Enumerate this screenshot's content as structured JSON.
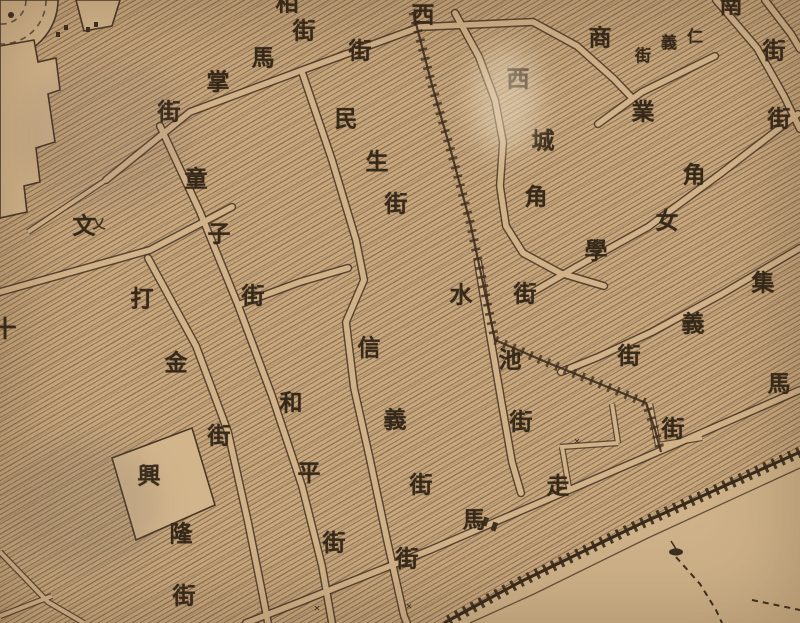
{
  "map": {
    "kind": "antique-chinese-city-street-map",
    "language": "Chinese (traditional), labels read vertically / along streets",
    "colors": {
      "paper": "#c8a77d",
      "road_fill": "#d2b289",
      "ink": "#3f2f1f",
      "label_ink": "#37291a",
      "hatch_line": "rgba(72,54,36,0.42)"
    },
    "default_char_size": 23,
    "streets": [
      {
        "id": "mazhang-jie",
        "name": "馬掌街",
        "chars": [
          {
            "ch": "馬",
            "x": 263,
            "y": 58
          },
          {
            "ch": "掌",
            "x": 218,
            "y": 82
          },
          {
            "ch": "街",
            "x": 169,
            "y": 112
          }
        ]
      },
      {
        "id": "top-edge-street",
        "name": "相街(上緣截斷)",
        "chars": [
          {
            "ch": "相",
            "x": 287,
            "y": 3
          },
          {
            "ch": "街",
            "x": 304,
            "y": 31
          }
        ]
      },
      {
        "id": "xi-jie",
        "name": "西街",
        "chars": [
          {
            "ch": "西",
            "x": 423,
            "y": 15
          },
          {
            "ch": "街",
            "x": 360,
            "y": 51
          }
        ]
      },
      {
        "id": "minsheng-jie",
        "name": "民生街",
        "chars": [
          {
            "ch": "民",
            "x": 346,
            "y": 119
          },
          {
            "ch": "生",
            "x": 377,
            "y": 162
          },
          {
            "ch": "街",
            "x": 396,
            "y": 204
          }
        ]
      },
      {
        "id": "xicheng-jiao",
        "name": "西城角",
        "chars": [
          {
            "ch": "西",
            "x": 518,
            "y": 79
          },
          {
            "ch": "城",
            "x": 543,
            "y": 141
          },
          {
            "ch": "角",
            "x": 536,
            "y": 197
          }
        ]
      },
      {
        "id": "shangye-jiao",
        "name": "商業角",
        "chars": [
          {
            "ch": "商",
            "x": 600,
            "y": 38
          },
          {
            "ch": "業",
            "x": 643,
            "y": 112
          },
          {
            "ch": "角",
            "x": 694,
            "y": 175
          }
        ]
      },
      {
        "id": "renyi-jie",
        "name": "仁義街",
        "chars": [
          {
            "ch": "仁",
            "x": 695,
            "y": 38,
            "size": 16
          },
          {
            "ch": "義",
            "x": 669,
            "y": 44,
            "size": 16
          },
          {
            "ch": "街",
            "x": 643,
            "y": 57,
            "size": 16
          }
        ]
      },
      {
        "id": "nan-jie",
        "name": "南…街(右上)",
        "chars": [
          {
            "ch": "南",
            "x": 731,
            "y": 5
          },
          {
            "ch": "街",
            "x": 774,
            "y": 51
          }
        ]
      },
      {
        "id": "right-edge-jie",
        "name": "…街(右緣)",
        "chars": [
          {
            "ch": "街",
            "x": 779,
            "y": 119
          }
        ]
      },
      {
        "id": "nvxue-jie",
        "name": "女學街",
        "chars": [
          {
            "ch": "女",
            "x": 667,
            "y": 221
          },
          {
            "ch": "學",
            "x": 596,
            "y": 251
          },
          {
            "ch": "街",
            "x": 525,
            "y": 294
          }
        ]
      },
      {
        "id": "shuichi-jie",
        "name": "水池街",
        "chars": [
          {
            "ch": "水",
            "x": 461,
            "y": 295
          },
          {
            "ch": "池",
            "x": 510,
            "y": 360
          },
          {
            "ch": "街",
            "x": 521,
            "y": 422
          }
        ]
      },
      {
        "id": "jiyi-jie",
        "name": "集義街",
        "chars": [
          {
            "ch": "集",
            "x": 763,
            "y": 283
          },
          {
            "ch": "義",
            "x": 693,
            "y": 324
          },
          {
            "ch": "街",
            "x": 629,
            "y": 356
          }
        ]
      },
      {
        "id": "ma-jie",
        "name": "馬…街(沿江路)",
        "chars": [
          {
            "ch": "馬",
            "x": 779,
            "y": 384
          },
          {
            "ch": "街",
            "x": 673,
            "y": 429
          }
        ]
      },
      {
        "id": "zouma-jie",
        "name": "走馬街",
        "chars": [
          {
            "ch": "走",
            "x": 558,
            "y": 486
          },
          {
            "ch": "馬",
            "x": 474,
            "y": 520
          },
          {
            "ch": "街",
            "x": 407,
            "y": 559
          }
        ]
      },
      {
        "id": "wen-label",
        "name": "文",
        "chars": [
          {
            "ch": "文",
            "x": 84,
            "y": 226
          }
        ]
      },
      {
        "id": "dajin-jie",
        "name": "打金街",
        "chars": [
          {
            "ch": "打",
            "x": 142,
            "y": 299
          },
          {
            "ch": "金",
            "x": 176,
            "y": 363
          },
          {
            "ch": "街",
            "x": 219,
            "y": 436
          }
        ]
      },
      {
        "id": "tongzi-jie",
        "name": "童子街",
        "chars": [
          {
            "ch": "童",
            "x": 196,
            "y": 179
          },
          {
            "ch": "子",
            "x": 219,
            "y": 234
          },
          {
            "ch": "街",
            "x": 253,
            "y": 296
          }
        ]
      },
      {
        "id": "heping-jie",
        "name": "和平街",
        "chars": [
          {
            "ch": "和",
            "x": 291,
            "y": 403
          },
          {
            "ch": "平",
            "x": 309,
            "y": 473
          },
          {
            "ch": "街",
            "x": 334,
            "y": 543
          }
        ]
      },
      {
        "id": "xinyi-jie",
        "name": "信義街",
        "chars": [
          {
            "ch": "信",
            "x": 369,
            "y": 348
          },
          {
            "ch": "義",
            "x": 395,
            "y": 420
          },
          {
            "ch": "街",
            "x": 421,
            "y": 485
          }
        ]
      },
      {
        "id": "xinglong-jie",
        "name": "興隆街",
        "chars": [
          {
            "ch": "興",
            "x": 149,
            "y": 476
          },
          {
            "ch": "隆",
            "x": 181,
            "y": 534
          },
          {
            "ch": "街",
            "x": 184,
            "y": 596
          }
        ]
      },
      {
        "id": "left-edge-partial",
        "name": "十(左緣截斷)",
        "chars": [
          {
            "ch": "十",
            "x": 5,
            "y": 329
          }
        ]
      }
    ],
    "marks": [
      {
        "ch": "乂",
        "x": 99,
        "y": 224,
        "size": 13
      },
      {
        "ch": "×",
        "x": 317,
        "y": 608,
        "size": 12
      },
      {
        "ch": "×",
        "x": 409,
        "y": 606,
        "size": 12
      },
      {
        "ch": "×",
        "x": 577,
        "y": 441,
        "size": 12
      }
    ]
  }
}
